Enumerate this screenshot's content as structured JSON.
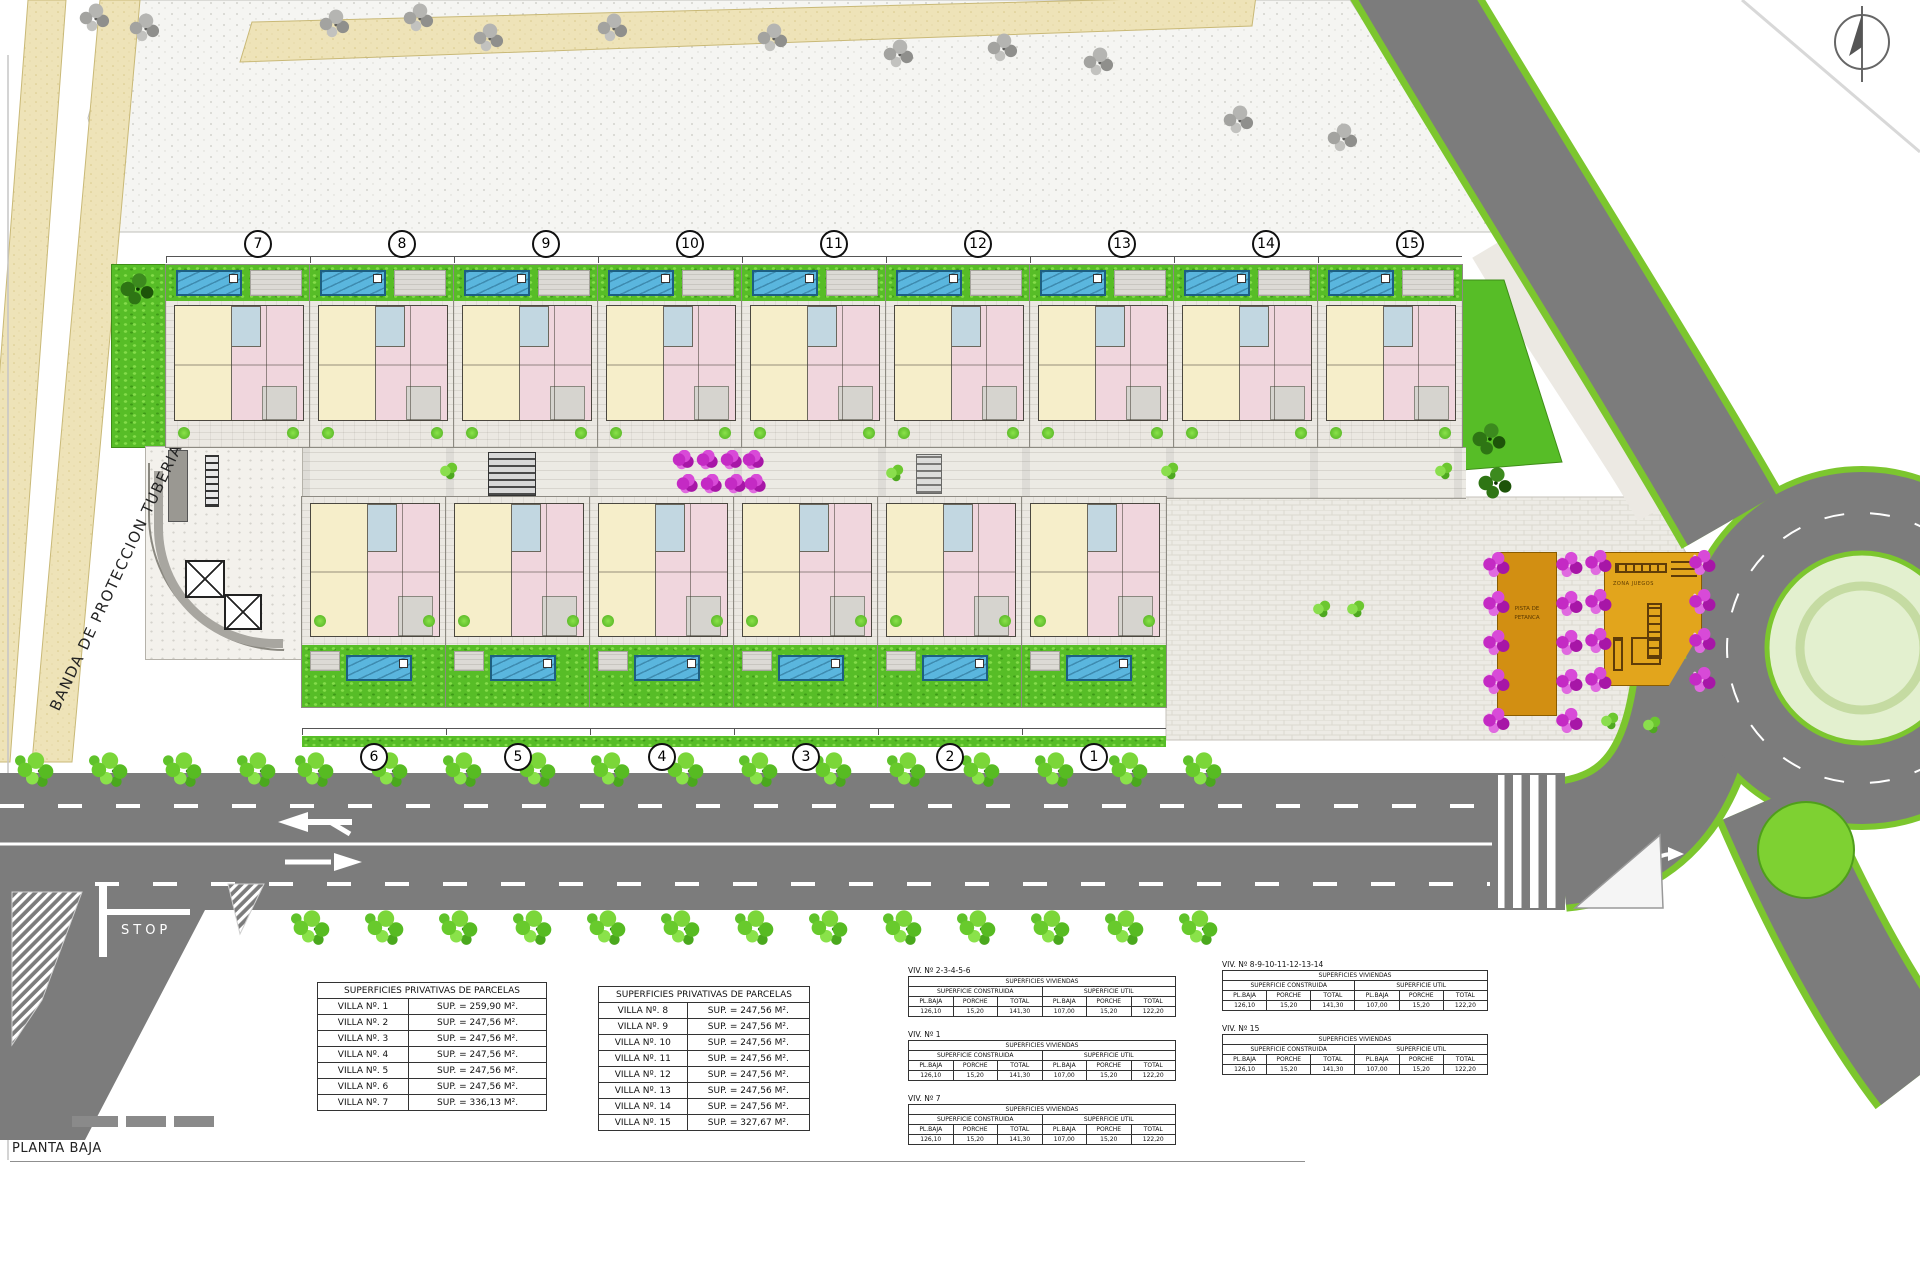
{
  "plan": {
    "floor_label": "PLANTA BAJA"
  },
  "band_label": "BANDA DE PROTECCION TUBERIA ABASTECIMIENTO",
  "road": {
    "stop": "STOP"
  },
  "plots": {
    "top": [
      "7",
      "8",
      "9",
      "10",
      "11",
      "12",
      "13",
      "14",
      "15"
    ],
    "bottom": [
      "6",
      "5",
      "4",
      "3",
      "2",
      "1"
    ]
  },
  "amenities": {
    "petanca_line1": "PISTA DE",
    "petanca_line2": "PETANCA",
    "playground": "ZONA JUEGOS"
  },
  "parcel_tables": [
    {
      "title": "SUPERFICIES PRIVATIVAS DE PARCELAS",
      "rows": [
        [
          "VILLA Nº. 1",
          "SUP. = 259,90 M²."
        ],
        [
          "VILLA Nº. 2",
          "SUP. = 247,56 M²."
        ],
        [
          "VILLA Nº. 3",
          "SUP. = 247,56 M²."
        ],
        [
          "VILLA Nº. 4",
          "SUP. = 247,56 M²."
        ],
        [
          "VILLA Nº. 5",
          "SUP. = 247,56 M²."
        ],
        [
          "VILLA Nº. 6",
          "SUP. = 247,56 M²."
        ],
        [
          "VILLA Nº. 7",
          "SUP. = 336,13 M²."
        ]
      ]
    },
    {
      "title": "SUPERFICIES PRIVATIVAS DE PARCELAS",
      "rows": [
        [
          "VILLA Nº. 8",
          "SUP. = 247,56 M²."
        ],
        [
          "VILLA Nº. 9",
          "SUP. = 247,56 M²."
        ],
        [
          "VILLA Nº. 10",
          "SUP. = 247,56 M²."
        ],
        [
          "VILLA Nº. 11",
          "SUP. = 247,56 M²."
        ],
        [
          "VILLA Nº. 12",
          "SUP. = 247,56 M²."
        ],
        [
          "VILLA Nº. 13",
          "SUP. = 247,56 M²."
        ],
        [
          "VILLA Nº. 14",
          "SUP. = 247,56 M²."
        ],
        [
          "VILLA Nº. 15",
          "SUP. = 327,67 M²."
        ]
      ]
    }
  ],
  "viv_header": {
    "title": "SUPERFICIES VIVIENDAS",
    "built": "SUPERFICIE CONSTRUIDA",
    "useful": "SUPERFICIE UTIL",
    "cols": [
      "PL.BAJA",
      "PORCHE",
      "TOTAL",
      "PL.BAJA",
      "PORCHE",
      "TOTAL"
    ]
  },
  "viv_tables": [
    {
      "caption": "VIV. Nº 2-3-4-5-6",
      "values": [
        "126,10",
        "15,20",
        "141,30",
        "107,00",
        "15,20",
        "122,20"
      ]
    },
    {
      "caption": "VIV. Nº 1",
      "values": [
        "126,10",
        "15,20",
        "141,30",
        "107,00",
        "15,20",
        "122,20"
      ]
    },
    {
      "caption": "VIV. Nº 7",
      "values": [
        "126,10",
        "15,20",
        "141,30",
        "107,00",
        "15,20",
        "122,20"
      ]
    },
    {
      "caption": "VIV. Nº 8-9-10-11-12-13-14",
      "values": [
        "126,10",
        "15,20",
        "141,30",
        "107,00",
        "15,20",
        "122,20"
      ]
    },
    {
      "caption": "VIV. Nº 15",
      "values": [
        "126,10",
        "15,20",
        "141,30",
        "107,00",
        "15,20",
        "122,20"
      ]
    }
  ],
  "colors": {
    "road": "#7c7c7c",
    "lawn": "#57bd27",
    "pool": "#5ab6de",
    "living": "#f6eeca",
    "bedroom": "#f0d6dd",
    "band_beige": "#eee3b8",
    "flower": "#c42ac4",
    "petanca": "#d28f12",
    "verge_green": "#7cc62e"
  }
}
